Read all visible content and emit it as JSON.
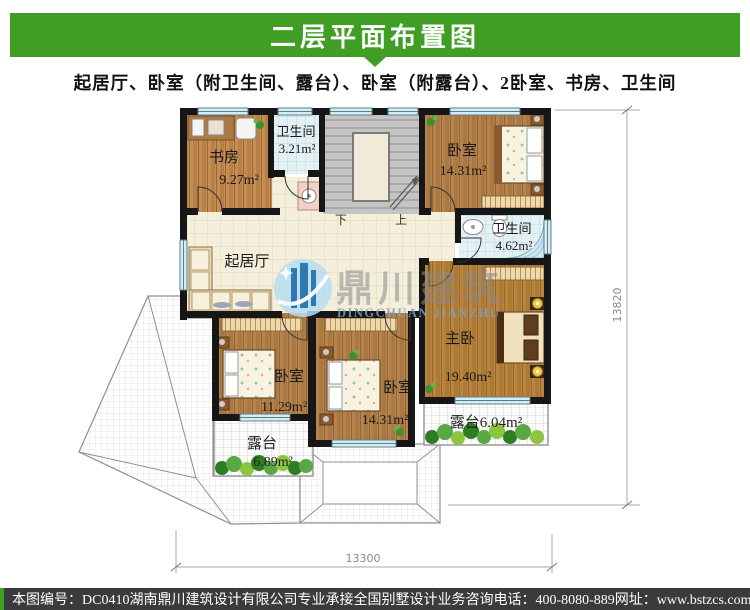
{
  "header": {
    "title": "二层平面布置图",
    "accent_color": "#3f9e23"
  },
  "subtitle": "起居厅、卧室（附卫生间、露台）、卧室（附露台）、2卧室、书房、卫生间",
  "watermark": {
    "cn": "鼎川建筑",
    "en": "DINGCHUAN JIANZHU",
    "logo_color": "#1c6fae"
  },
  "plan": {
    "rooms": {
      "study": {
        "name": "书房",
        "area": "9.27m²"
      },
      "bath1": {
        "name": "卫生间",
        "area": "3.21m²"
      },
      "bed_tr": {
        "name": "卧室",
        "area": "14.31m²"
      },
      "bath2": {
        "name": "卫生间",
        "area": "4.62m²"
      },
      "living": {
        "name": "起居厅"
      },
      "master": {
        "name": "主卧",
        "area": "19.40m²"
      },
      "bed_bl": {
        "name": "卧室",
        "area": "11.29m²"
      },
      "bed_bm": {
        "name": "卧室",
        "area": "14.31m²"
      },
      "terrace_l": {
        "name": "露台",
        "area": "6.89m²"
      },
      "terrace_r": {
        "name": "露台",
        "area": "6.04m²"
      }
    },
    "stairs": {
      "down": "下",
      "up": "上"
    },
    "dimensions": {
      "height_mm": "13820",
      "width_mm": "13300"
    },
    "colors": {
      "wall": "#161616",
      "wood": "#b5834c",
      "bath_tile": "#e3f0f4",
      "window": "#d4edf4"
    }
  },
  "footer": {
    "plan_no": "本图编号：DC0410",
    "company": "湖南鼎川建筑设计有限公司专业承接全国别墅设计业务",
    "phone": "咨询电话：400-8080-889",
    "website": "网址：www.bstzcs.com"
  }
}
